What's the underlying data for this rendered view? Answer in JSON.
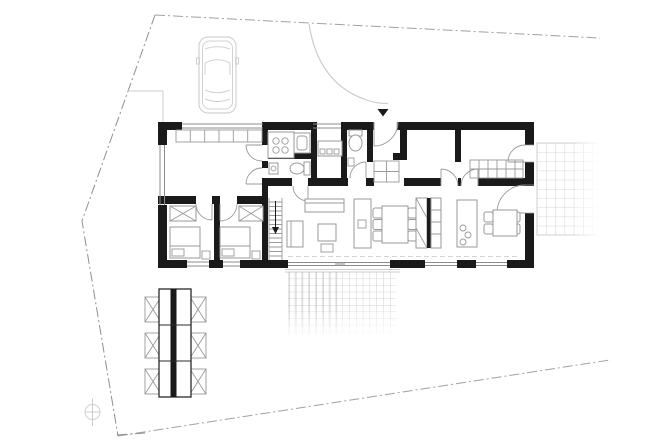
{
  "meta": {
    "title": "Single-storey house floor plan with site boundary, parked car, terraces and garden table",
    "canvas_width": 650,
    "canvas_height": 448
  },
  "colors": {
    "paper": "#ffffff",
    "wall": "#1a1a1a",
    "line": "#9a9a9a",
    "light": "#cdcdcd",
    "grid": "#c7c7c7",
    "griddark": "#a9a9a9",
    "boundary": "#909090",
    "glass": "#8c8c8c"
  },
  "site": {
    "boundary_line_style": "dash-dot lot line, irregular quadrilateral, fading at right ends",
    "north_symbol": "small circle with cross hair, bottom-left",
    "car": "parked car seen from above, light grey outline, top-left",
    "entry_path": "curved light walkway from north boundary to front door",
    "entry_marker": "small filled black triangle above entrance door"
  },
  "house": {
    "storey": "ground floor",
    "outer_wall": "thick black poché",
    "rooms": [
      {
        "name": "garage-storage-room",
        "features": [
          "hatched closet strip along top wall",
          "double doors on east wall"
        ]
      },
      {
        "name": "utility-room",
        "features": [
          "appliance block with four burners/dials",
          "sink unit"
        ]
      },
      {
        "name": "wc-1",
        "features": [
          "toilet",
          "small basin"
        ]
      },
      {
        "name": "entry-hall",
        "features": [
          "sideboard with drawers",
          "window to north"
        ]
      },
      {
        "name": "wc-2",
        "features": [
          "toilet",
          "small cabinet"
        ]
      },
      {
        "name": "hallway",
        "features": [
          "entrance door",
          "hatched built-in closet"
        ]
      },
      {
        "name": "bedroom-north-1",
        "features": [
          "door from corridor"
        ]
      },
      {
        "name": "bedroom-north-2",
        "features": [
          "hatched wardrobe strip",
          "door to east terrace"
        ]
      },
      {
        "name": "bedroom-south-1",
        "features": [
          "bed",
          "x-front wardrobe",
          "nightstand",
          "window"
        ]
      },
      {
        "name": "bedroom-south-2",
        "features": [
          "bed",
          "x-front wardrobe",
          "nightstand",
          "window"
        ]
      },
      {
        "name": "staircase",
        "features": [
          "treads with direction arrow"
        ]
      },
      {
        "name": "living-dining-kitchen",
        "features": [
          "sofa",
          "armchair",
          "coffee table",
          "pouf",
          "tv-board",
          "dining table with 6 chairs",
          "tall cabinet block with black core",
          "kitchen island with sink",
          "breakfast table with 4 chairs",
          "full-height glazing to south terrace"
        ]
      }
    ]
  },
  "terraces": [
    {
      "name": "east-terrace",
      "pattern": "square paving grid, fades to the east"
    },
    {
      "name": "south-terrace",
      "pattern": "square paving grid with denser west half, fades to the south",
      "step": "double edge line at house wall"
    }
  ],
  "garden": {
    "table_set": "long rectangular garden table with black centre spine, 3 sections",
    "chairs": 6,
    "chair_style": "x-frame folding chairs, three per long side"
  }
}
